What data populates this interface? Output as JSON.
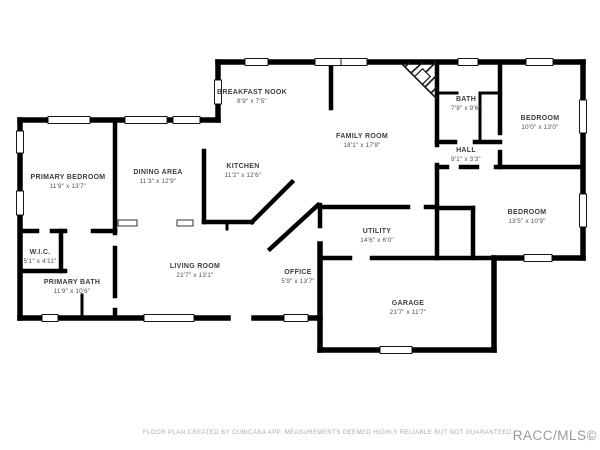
{
  "page": {
    "background": "#ffffff"
  },
  "colors": {
    "wall": "#000000",
    "room_label": "#3d3d3d",
    "room_dims": "#4f4f4f",
    "footer_text": "#ababab",
    "brand_text": "#9a9a9a"
  },
  "rooms": [
    {
      "name": "PRIMARY BEDROOM",
      "dims": "11'9\" x 13'7\""
    },
    {
      "name": "W.I.C.",
      "dims": "5'1\" x 4'11\""
    },
    {
      "name": "PRIMARY BATH",
      "dims": "11'9\" x 10'6\""
    },
    {
      "name": "DINING AREA",
      "dims": "11'3\" x 12'9\""
    },
    {
      "name": "KITCHEN",
      "dims": "11'2\" x 12'6\""
    },
    {
      "name": "BREAKFAST NOOK",
      "dims": "8'9\" x 7'5\""
    },
    {
      "name": "FAMILY ROOM",
      "dims": "18'1\" x 17'9\""
    },
    {
      "name": "BATH",
      "dims": "7'9\" x 9'6\""
    },
    {
      "name": "BEDROOM",
      "dims": "10'0\" x 13'0\""
    },
    {
      "name": "HALL",
      "dims": "8'1\" x 3'3\""
    },
    {
      "name": "BEDROOM",
      "dims": "13'5\" x 10'9\""
    },
    {
      "name": "UTILITY",
      "dims": "14'6\" x 6'0\""
    },
    {
      "name": "LIVING ROOM",
      "dims": "22'7\" x 13'1\""
    },
    {
      "name": "OFFICE",
      "dims": "5'9\" x 13'7\""
    },
    {
      "name": "GARAGE",
      "dims": "21'7\" x 11'7\""
    }
  ],
  "footer": {
    "disclaimer": "FLOOR PLAN CREATED BY CUBICASA APP. MEASUREMENTS DEEMED HIGHLY RELIABLE BUT NOT GUARANTEED.",
    "brand": "RACC/MLS©"
  }
}
